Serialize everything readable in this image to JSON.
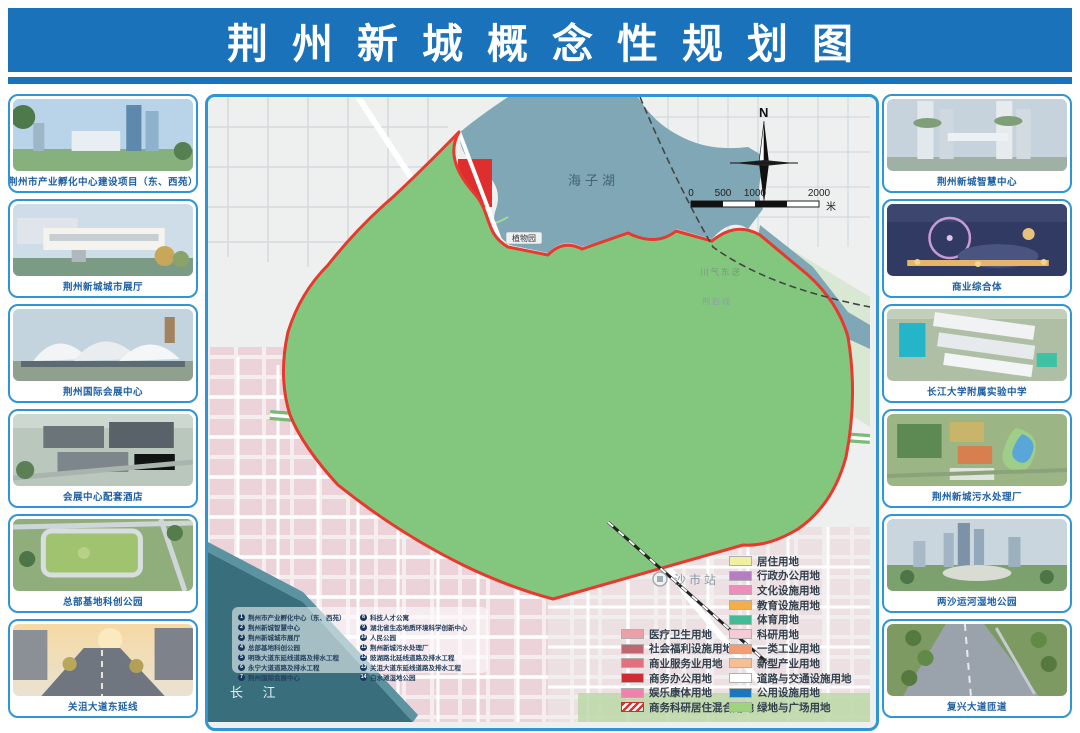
{
  "title": "荆州新城概念性规划图",
  "left_sidebar": {
    "items": [
      {
        "caption": "荆州市产业孵化中心建设项目（东、西苑）"
      },
      {
        "caption": "荆州新城城市展厅"
      },
      {
        "caption": "荆州国际会展中心"
      },
      {
        "caption": "会展中心配套酒店"
      },
      {
        "caption": "总部基地科创公园"
      },
      {
        "caption": "关沮大道东延线"
      }
    ]
  },
  "right_sidebar": {
    "items": [
      {
        "caption": "荆州新城智慧中心"
      },
      {
        "caption": "商业综合体"
      },
      {
        "caption": "长江大学附属实验中学"
      },
      {
        "caption": "荆州新城污水处理厂"
      },
      {
        "caption": "两沙运河湿地公园"
      },
      {
        "caption": "复兴大道匝道"
      }
    ]
  },
  "map": {
    "labels": {
      "lake": "海子湖",
      "garden": "植物园",
      "pipeline": "川气东送",
      "rail_line": "荆石线",
      "station": "沙市站",
      "river": "长 江",
      "north": "N"
    },
    "scalebar": {
      "t0": "0",
      "t1": "500",
      "t2": "1000",
      "t3": "2000",
      "unit": "米"
    },
    "legend": {
      "left": [
        {
          "label": "医疗卫生用地",
          "color": "#eb9fa6"
        },
        {
          "label": "社会福利设施用地",
          "color": "#c16570"
        },
        {
          "label": "商业服务业用地",
          "color": "#e2707f"
        },
        {
          "label": "商务办公用地",
          "color": "#cf2b32"
        },
        {
          "label": "娱乐康体用地",
          "color": "#ee82ad"
        },
        {
          "label": "商务科研居住混合用地",
          "color": "repeating-linear-gradient(135deg,#d7352f 0,#d7352f 2.5px,#ffffff 2.5px,#ffffff 5px)"
        }
      ],
      "right": [
        {
          "label": "居住用地",
          "color": "#f1efa0"
        },
        {
          "label": "行政办公用地",
          "color": "#b77dc2"
        },
        {
          "label": "文化设施用地",
          "color": "#ee8cba"
        },
        {
          "label": "教育设施用地",
          "color": "#f3ae49"
        },
        {
          "label": "体育用地",
          "color": "#43bb95"
        },
        {
          "label": "科研用地",
          "color": "#f5cbd7"
        },
        {
          "label": "一类工业用地",
          "color": "#f39b73"
        },
        {
          "label": "新型产业用地",
          "color": "#f7bd93"
        },
        {
          "label": "道路与交通设施用地",
          "color": "#ffffff"
        },
        {
          "label": "公用设施用地",
          "color": "#1a78bd"
        },
        {
          "label": "绿地与广场用地",
          "color": "#9ed47e"
        }
      ]
    },
    "projects": {
      "left": [
        {
          "n": "1",
          "t": "荆州市产业孵化中心（东、西苑）"
        },
        {
          "n": "2",
          "t": "荆州新城智慧中心"
        },
        {
          "n": "3",
          "t": "荆州新城城市展厅"
        },
        {
          "n": "4",
          "t": "总部基地科创公园"
        },
        {
          "n": "5",
          "t": "明珠大道东延线道路及排水工程"
        },
        {
          "n": "6",
          "t": "永宁大道道路及排水工程"
        },
        {
          "n": "7",
          "t": "荆州国际会展中心"
        }
      ],
      "right": [
        {
          "n": "8",
          "t": "科技人才公寓"
        },
        {
          "n": "9",
          "t": "湖北省生态地质环境科学创新中心"
        },
        {
          "n": "10",
          "t": "人民公园"
        },
        {
          "n": "11",
          "t": "荆州新城污水处理厂"
        },
        {
          "n": "12",
          "t": "豉湖路北延线道路及排水工程"
        },
        {
          "n": "13",
          "t": "关沮大道东延线道路及排水工程"
        },
        {
          "n": "14",
          "t": "白水滩湿地公园"
        }
      ]
    }
  },
  "colors": {
    "header_blue": "#1a72ba",
    "frame_blue": "#2f95d4",
    "boundary_red": "#e8392f",
    "planning_green": "#83c77e",
    "water": "#7fa7b5",
    "river": "#396f7d"
  }
}
